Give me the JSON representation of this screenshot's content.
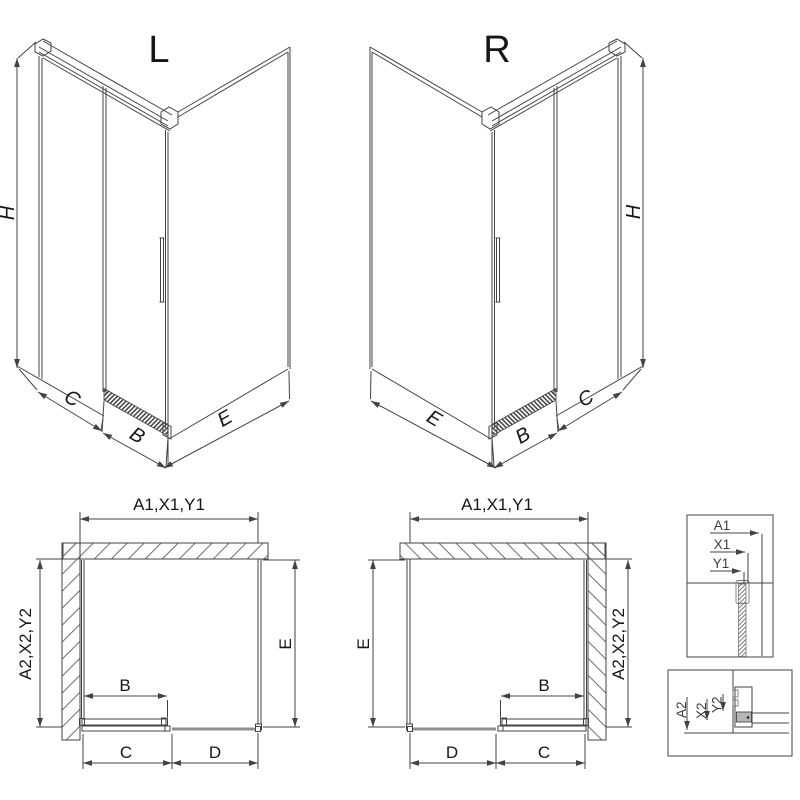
{
  "diagram": {
    "title_variants": {
      "left": "L",
      "right": "R"
    },
    "dims": {
      "height": "H",
      "door_width": "B",
      "fixed_segment": "C",
      "front_fixed_panel": "D",
      "side_panel": "E"
    },
    "codes": {
      "width_group": "A1,X1,Y1",
      "depth_group": "A2,X2,Y2",
      "a1": "A1",
      "x1": "X1",
      "y1": "Y1",
      "a2": "A2",
      "x2": "X2",
      "y2": "Y2"
    },
    "views": {
      "perspective": [
        {
          "variant": "L",
          "dimension_labels": [
            "H",
            "C",
            "B",
            "E"
          ]
        },
        {
          "variant": "R",
          "dimension_labels": [
            "H",
            "E",
            "B",
            "C"
          ]
        }
      ],
      "plan": [
        {
          "variant": "L",
          "top": "A1,X1,Y1",
          "left": "A2,X2,Y2",
          "right": "E",
          "door": "B",
          "bottom": [
            "C",
            "D"
          ]
        },
        {
          "variant": "R",
          "top": "A1,X1,Y1",
          "left": "E",
          "right": "A2,X2,Y2",
          "door": "B",
          "bottom": [
            "D",
            "C"
          ]
        }
      ],
      "details": [
        {
          "position": "top-right",
          "labels": [
            "A1",
            "X1",
            "Y1"
          ]
        },
        {
          "position": "bottom-right",
          "labels": [
            "A2",
            "X2",
            "Y2"
          ]
        }
      ]
    },
    "colors": {
      "line": "#434343",
      "text": "#161616",
      "hatch": "#6f6f6f",
      "panel": "#8f8f8f",
      "background": "#ffffff"
    }
  }
}
